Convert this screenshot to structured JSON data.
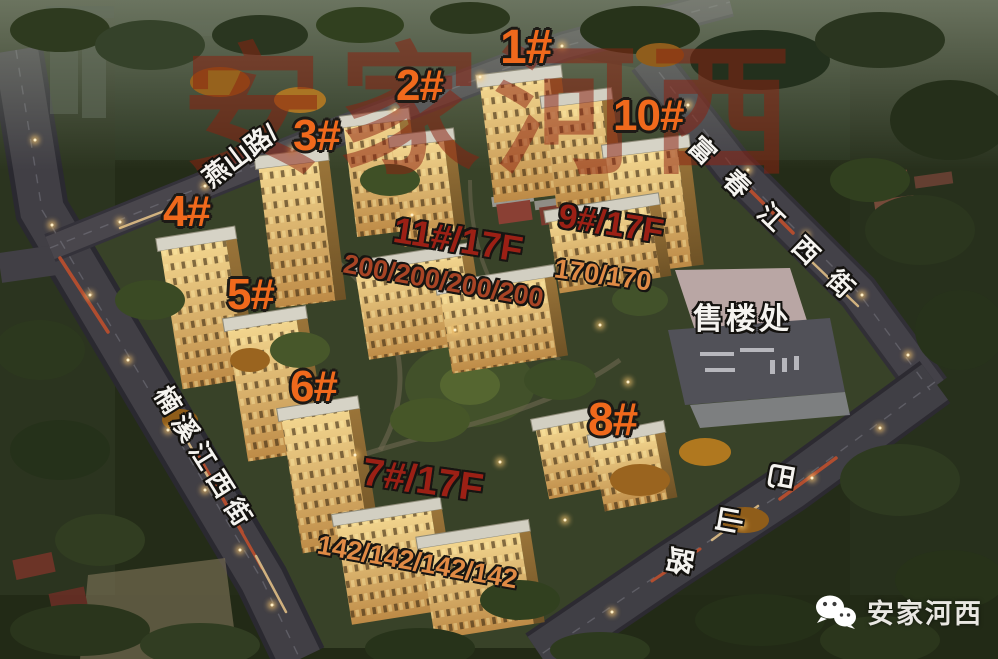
{
  "watermark": {
    "text": "安家河西"
  },
  "buildings": [
    {
      "label": "1#"
    },
    {
      "label": "2#"
    },
    {
      "label": "3#"
    },
    {
      "label": "4#"
    },
    {
      "label": "5#"
    },
    {
      "label": "6#"
    },
    {
      "label": "7#/17F"
    },
    {
      "label": "8#"
    },
    {
      "label": "9#/17F"
    },
    {
      "label": "10#"
    },
    {
      "label": "11#/17F"
    }
  ],
  "unit_counts": [
    {
      "building_ref": "11#",
      "text": "200/200/200/200"
    },
    {
      "building_ref": "9#",
      "text": "170/170"
    },
    {
      "building_ref": "7#",
      "text": "142/142/142/142"
    }
  ],
  "streets": [
    {
      "name": "燕山路",
      "pointer_mark": "/"
    },
    {
      "name": "富春江西街"
    },
    {
      "name": "楠溪江西街"
    },
    {
      "name": "巴山路",
      "chars": [
        "巴",
        "山",
        "路"
      ]
    }
  ],
  "landmarks": {
    "sales_office": "售楼处"
  },
  "attribution": {
    "name": "安家河西",
    "icon": "wechat-icon"
  },
  "colors": {
    "label_orange": "#f0691c",
    "label_dark_red": "#9c2015",
    "label_red_brown": "#a84425",
    "label_tan_orange": "#e08a45",
    "street_name_white": "#f5f3ef",
    "watermark_red": "#8c2210",
    "source_text_white": "#e9e7e2"
  }
}
